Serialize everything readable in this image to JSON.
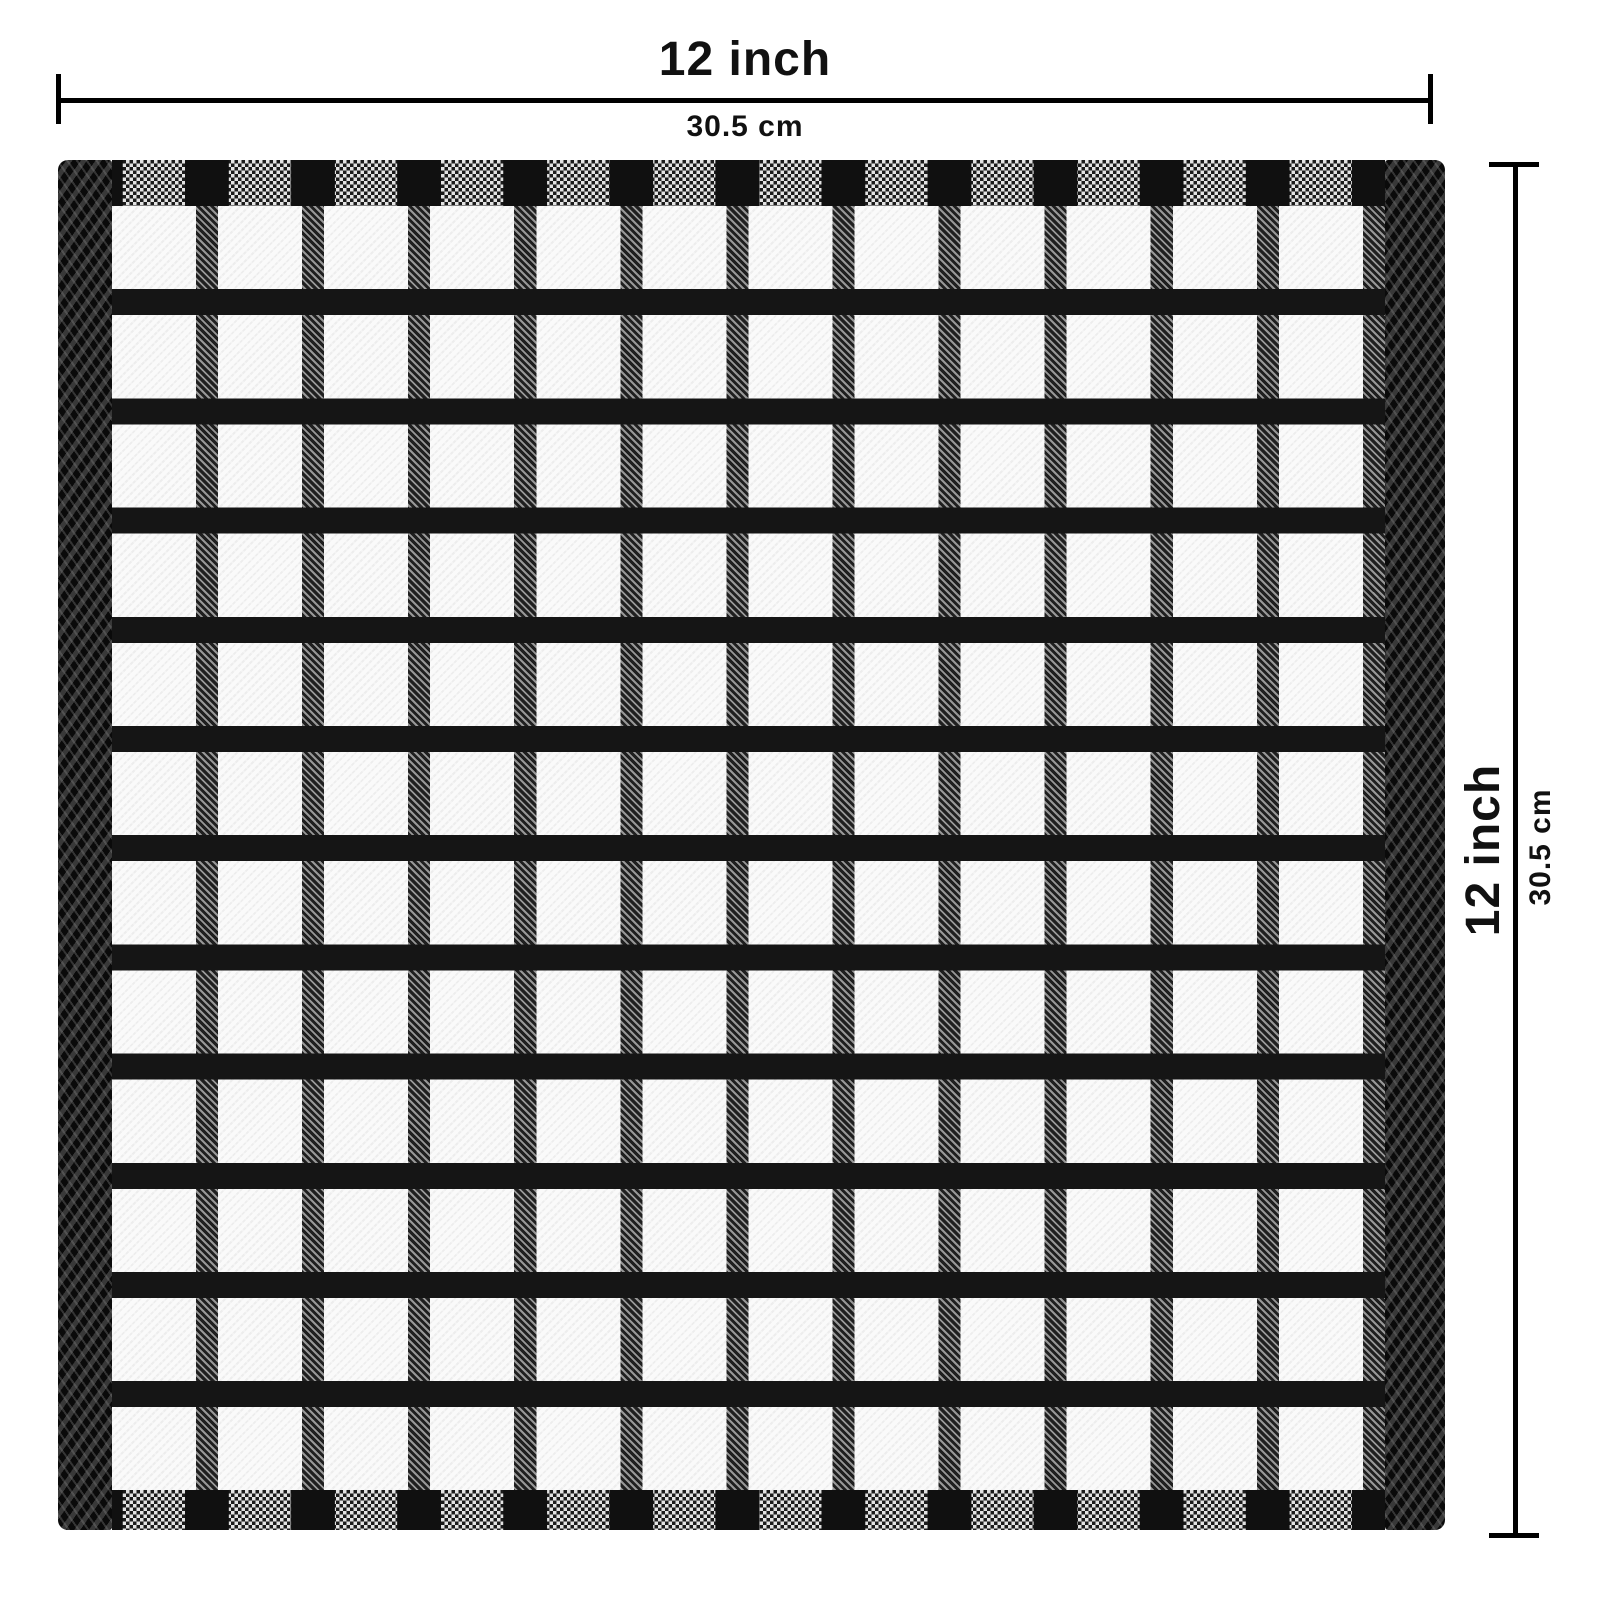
{
  "diagram": {
    "width_dimension": {
      "label_inches": "12 inch",
      "label_cm": "30.5 cm"
    },
    "height_dimension": {
      "label_inches": "12 inch",
      "label_cm": "30.5 cm"
    }
  },
  "product": {
    "item": "black and white windowpane-check terry kitchen towel",
    "grid_columns": 12,
    "grid_rows": 12
  },
  "colors": {
    "dimension_line": "#000000",
    "label_text": "#111111",
    "towel_black": "#151515",
    "towel_white": "#f7f7f7"
  }
}
